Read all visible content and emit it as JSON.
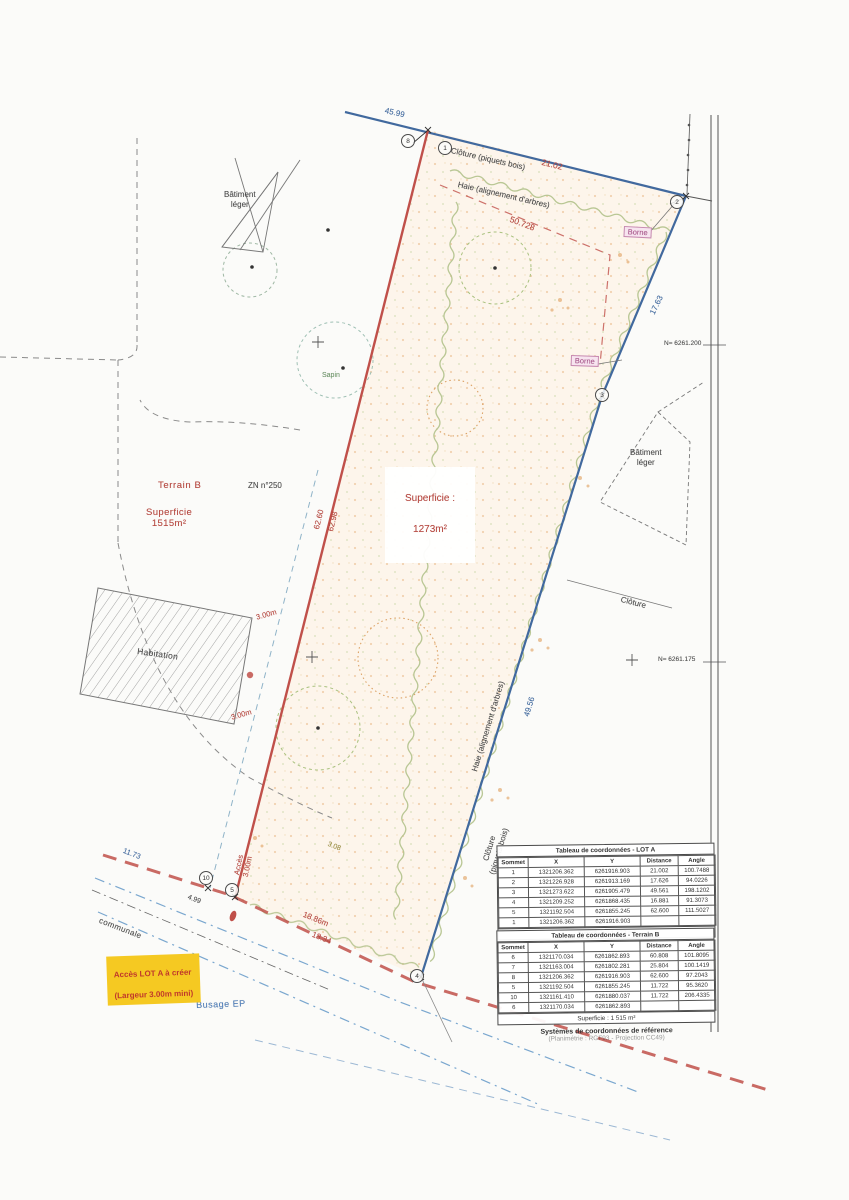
{
  "labels": {
    "cloture_top": "Clôture (piquets bois)",
    "haie_top": "Haie (alignement d'arbres)",
    "haie_right": "Haie (alignement d'arbres)",
    "cloture_right": "Clôture\n(piquets bois)",
    "cloture_east": "Clôture",
    "batiment_leger": "Bâtiment\nléger",
    "habitation": "Habitation",
    "sapin": "Sapin"
  },
  "measurements": {
    "top_blue": "45.99",
    "top_red": "21.02",
    "diag_red": "50.728",
    "right_upper": "17.63",
    "right_lower": "49.56",
    "left_red_1": "62.60",
    "left_red_2": "62.98",
    "bottom_blue": "11.73",
    "bottom_red_1": "18.86m",
    "bottom_red_2": "18.34",
    "hab_top": "3.00m",
    "hab_bottom": "3.00m",
    "acces": "Accès\n3.00m",
    "olive": "3.08",
    "small_black": "4.99"
  },
  "parcels": {
    "terrain_b": {
      "name": "Terrain B",
      "area": "Superficie\n1515m²"
    },
    "lot_a": {
      "area_label": "Superficie :",
      "area_value": "1273m²"
    },
    "zn": "ZN n°250"
  },
  "grid": {
    "n1": "N= 6261.200",
    "n2": "N= 6261.175"
  },
  "bornes": {
    "b1": "Borne",
    "b2": "Borne"
  },
  "vertices": {
    "v8": "8",
    "v1": "1",
    "v2": "2",
    "v3": "3",
    "v4": "4",
    "v10": "10",
    "v5": "5"
  },
  "road": {
    "communale": "communale",
    "busage": "Busage EP"
  },
  "access_note": {
    "line1": "Accès LOT A à créer",
    "line2": "(Largeur 3.00m mini)"
  },
  "tables": {
    "lot_a": {
      "title": "Tableau de coordonnées - LOT A",
      "headers": [
        "Sommet",
        "X",
        "Y",
        "Distance",
        "Angle"
      ],
      "rows": [
        [
          "1",
          "1321206.362",
          "6261916.903",
          "21.002",
          "100.7488"
        ],
        [
          "2",
          "1321226.928",
          "6261913.169",
          "17.626",
          "94.0226"
        ],
        [
          "3",
          "1321273.622",
          "6261905.479",
          "49.561",
          "198.1202"
        ],
        [
          "4",
          "1321209.252",
          "6261868.435",
          "16.881",
          "91.3073"
        ],
        [
          "5",
          "1321192.504",
          "6261855.245",
          "62.600",
          "111.5027"
        ],
        [
          "1",
          "1321206.362",
          "6261916.903",
          "",
          ""
        ]
      ],
      "footer": "Superficie : 1 273 m²"
    },
    "terrain_b": {
      "title": "Tableau de coordonnées - Terrain B",
      "headers": [
        "Sommet",
        "X",
        "Y",
        "Distance",
        "Angle"
      ],
      "rows": [
        [
          "6",
          "1321170.034",
          "6261862.893",
          "60.808",
          "101.8095"
        ],
        [
          "7",
          "1321163.004",
          "6261802.281",
          "25.804",
          "100.1419"
        ],
        [
          "8",
          "1321206.362",
          "6261916.903",
          "62.600",
          "97.2043"
        ],
        [
          "5",
          "1321192.504",
          "6261855.245",
          "11.722",
          "95.3620"
        ],
        [
          "10",
          "1321161.410",
          "6261880.037",
          "11.722",
          "206.4335"
        ],
        [
          "6",
          "1321170.034",
          "6261862.893",
          "",
          ""
        ]
      ],
      "footer": "Superficie : 1 515 m²"
    },
    "crs_title": "Systèmes de coordonnées de référence",
    "crs_line": "(Planimétrie : RGF93 - Projection CC49)"
  },
  "colors": {
    "boundary_red": "#b5473f",
    "boundary_blue": "#41699e",
    "borne_pink": "#a8588b",
    "highlight_yellow": "#f2c41d",
    "hedge_green": "#b6c490",
    "note_red": "#c0392b"
  }
}
